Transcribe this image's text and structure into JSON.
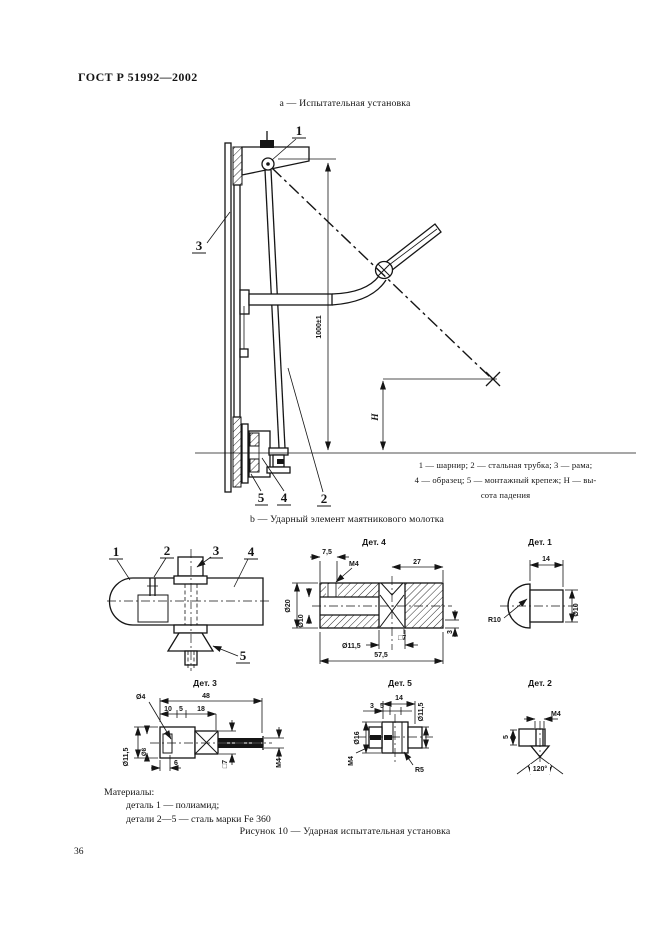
{
  "colors": {
    "ink": "#151515",
    "paper": "#ffffff"
  },
  "page": {
    "header": "ГОСТ Р 51992—2002",
    "page_number": "36",
    "figure_caption": "Рисунок 10 — Ударная испытательная установка",
    "materials_title": "Материалы:",
    "materials_line1": "деталь 1 — полиамид;",
    "materials_line2": "детали 2—5 — сталь марки Fe 360"
  },
  "figure_a": {
    "caption": "а — Испытательная установка",
    "dim_height": "1000±1",
    "dim_drop": "H",
    "labels": {
      "p1": "1",
      "p2": "2",
      "p3": "3",
      "p4": "4",
      "p5": "5"
    },
    "legend_line1": "1 — шарнир; 2 — стальная трубка; 3 — рама;",
    "legend_line2": "4 — образец; 5 — монтажный крепеж; Н — вы-",
    "legend_line3": "сота падения"
  },
  "figure_b": {
    "caption": "b — Ударный элемент маятникового молотка",
    "assembly": {
      "p1": "1",
      "p2": "2",
      "p3": "3",
      "p4": "4",
      "p5": "5"
    },
    "det1": {
      "title": "Дет. 1",
      "dim_len": "14",
      "dim_radius": "R10",
      "dim_dia": "Ø10"
    },
    "det2": {
      "title": "Дет. 2",
      "dim_thread": "M4",
      "dim_len": "5",
      "dim_angle": "120°"
    },
    "det3": {
      "title": "Дет. 3",
      "dim_total": "48",
      "dim_a": "10",
      "dim_b": "5",
      "dim_c": "18",
      "dim_hole": "Ø4",
      "dim_dia1": "Ø11,5",
      "dim_dia2": "Ø8",
      "dim_depth": "6",
      "dim_square": "□7",
      "dim_thread": "M4"
    },
    "det4": {
      "title": "Дет. 4",
      "dim_a": "7,5",
      "dim_thread": "M4",
      "dim_b": "27",
      "dim_dia1": "Ø20",
      "dim_dia2": "Ø10",
      "dim_dia3": "Ø11,5",
      "dim_square": "□7",
      "dim_c": "3",
      "dim_total": "57,5"
    },
    "det5": {
      "title": "Дет. 5",
      "dim_a": "14",
      "dim_b": "3",
      "dim_c": "5",
      "dim_dia1": "Ø11,5",
      "dim_dia2": "Ø16",
      "dim_thread": "M4",
      "dim_radius": "R5"
    }
  }
}
